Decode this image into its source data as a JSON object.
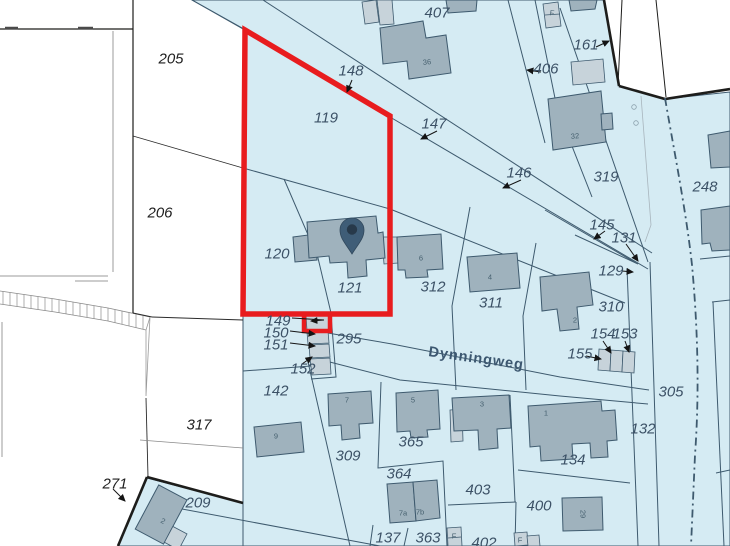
{
  "map": {
    "street_label": "Dynningweg",
    "selected_parcel": {
      "number": "119",
      "outline_color": "#e81c1e"
    },
    "pin": {
      "x": 352,
      "y": 254
    },
    "colors": {
      "parcel_fill": "#d5ebf3",
      "boundary_line": "#3e5a6e",
      "building_fill": "#9fb2bd",
      "building_light_fill": "#c7d3da",
      "red_outline": "#e81c1e",
      "pin": "#3f5d77",
      "label_blue": "#3c5166",
      "label_dark": "#1f1f1f",
      "street_label_color": "#3c5770"
    },
    "parcel_labels": [
      {
        "text": "205",
        "x": 171,
        "y": 59,
        "area": "white"
      },
      {
        "text": "206",
        "x": 160,
        "y": 213,
        "area": "white"
      },
      {
        "text": "317",
        "x": 199,
        "y": 425,
        "area": "white"
      },
      {
        "text": "271",
        "x": 115,
        "y": 484,
        "area": "white"
      },
      {
        "text": "209",
        "x": 198,
        "y": 503,
        "area": "blue"
      },
      {
        "text": "407",
        "x": 437,
        "y": 13,
        "area": "blue"
      },
      {
        "text": "148",
        "x": 351,
        "y": 71,
        "area": "blue"
      },
      {
        "text": "119",
        "x": 326,
        "y": 118,
        "area": "blue"
      },
      {
        "text": "147",
        "x": 434,
        "y": 124,
        "area": "blue"
      },
      {
        "text": "146",
        "x": 519,
        "y": 173,
        "area": "blue"
      },
      {
        "text": "406",
        "x": 546,
        "y": 69,
        "area": "blue"
      },
      {
        "text": "161",
        "x": 586,
        "y": 45,
        "area": "blue"
      },
      {
        "text": "319",
        "x": 606,
        "y": 177,
        "area": "blue"
      },
      {
        "text": "248",
        "x": 705,
        "y": 187,
        "area": "blue"
      },
      {
        "text": "145",
        "x": 602,
        "y": 225,
        "area": "blue"
      },
      {
        "text": "131",
        "x": 624,
        "y": 238,
        "area": "blue"
      },
      {
        "text": "129",
        "x": 611,
        "y": 271,
        "area": "blue"
      },
      {
        "text": "120",
        "x": 277,
        "y": 254,
        "area": "blue"
      },
      {
        "text": "121",
        "x": 350,
        "y": 288,
        "area": "blue"
      },
      {
        "text": "312",
        "x": 433,
        "y": 287,
        "area": "blue"
      },
      {
        "text": "311",
        "x": 491,
        "y": 303,
        "area": "blue"
      },
      {
        "text": "310",
        "x": 611,
        "y": 307,
        "area": "blue"
      },
      {
        "text": "154",
        "x": 603,
        "y": 334,
        "area": "blue"
      },
      {
        "text": "153",
        "x": 625,
        "y": 334,
        "area": "blue"
      },
      {
        "text": "155",
        "x": 580,
        "y": 354,
        "area": "blue"
      },
      {
        "text": "295",
        "x": 349,
        "y": 339,
        "area": "blue"
      },
      {
        "text": "149",
        "x": 278,
        "y": 321,
        "area": "blue"
      },
      {
        "text": "150",
        "x": 276,
        "y": 333,
        "area": "blue"
      },
      {
        "text": "151",
        "x": 276,
        "y": 345,
        "area": "blue"
      },
      {
        "text": "152",
        "x": 303,
        "y": 369,
        "area": "blue"
      },
      {
        "text": "142",
        "x": 276,
        "y": 391,
        "area": "blue"
      },
      {
        "text": "309",
        "x": 348,
        "y": 456,
        "area": "blue"
      },
      {
        "text": "365",
        "x": 411,
        "y": 442,
        "area": "blue"
      },
      {
        "text": "364",
        "x": 399,
        "y": 474,
        "area": "blue"
      },
      {
        "text": "403",
        "x": 478,
        "y": 490,
        "area": "blue"
      },
      {
        "text": "400",
        "x": 539,
        "y": 506,
        "area": "blue"
      },
      {
        "text": "134",
        "x": 573,
        "y": 460,
        "area": "blue"
      },
      {
        "text": "137",
        "x": 388,
        "y": 538,
        "area": "blue"
      },
      {
        "text": "363",
        "x": 428,
        "y": 538,
        "area": "blue"
      },
      {
        "text": "402",
        "x": 484,
        "y": 543,
        "area": "blue"
      },
      {
        "text": "305",
        "x": 671,
        "y": 392,
        "area": "blue"
      },
      {
        "text": "132",
        "x": 643,
        "y": 429,
        "area": "blue"
      }
    ],
    "building_labels": [
      {
        "text": "36",
        "x": 427,
        "y": 62,
        "rot": -5
      },
      {
        "text": "32",
        "x": 575,
        "y": 136,
        "rot": -5
      },
      {
        "text": "6",
        "x": 421,
        "y": 258,
        "rot": 0
      },
      {
        "text": "4",
        "x": 490,
        "y": 277,
        "rot": 0
      },
      {
        "text": "2",
        "x": 575,
        "y": 320,
        "rot": 0
      },
      {
        "text": "9",
        "x": 276,
        "y": 436,
        "rot": 0
      },
      {
        "text": "7",
        "x": 347,
        "y": 400,
        "rot": 0
      },
      {
        "text": "5",
        "x": 413,
        "y": 400,
        "rot": 0
      },
      {
        "text": "3",
        "x": 482,
        "y": 404,
        "rot": 0
      },
      {
        "text": "1",
        "x": 546,
        "y": 413,
        "rot": 0
      },
      {
        "text": "7a",
        "x": 403,
        "y": 513,
        "rot": 0,
        "size": 6.5
      },
      {
        "text": "7b",
        "x": 420,
        "y": 512,
        "rot": 0,
        "size": 6.5
      },
      {
        "text": "29",
        "x": 583,
        "y": 514,
        "rot": 90
      },
      {
        "text": "2",
        "x": 163,
        "y": 521,
        "rot": 28
      },
      {
        "text": "F",
        "x": 552,
        "y": 13,
        "rot": 8,
        "size": 6
      },
      {
        "text": "F",
        "x": 454,
        "y": 536,
        "rot": 0,
        "size": 6
      },
      {
        "text": "F",
        "x": 520,
        "y": 540,
        "rot": 0,
        "size": 6
      }
    ]
  }
}
